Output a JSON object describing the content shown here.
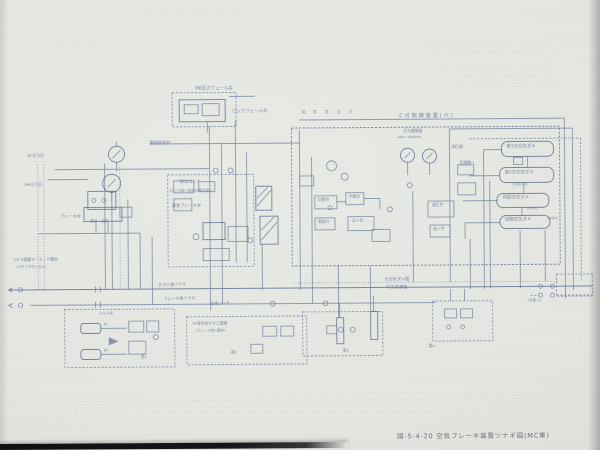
{
  "figure": {
    "caption": "図-5-4-20 空気ブレーキ装置ツナギ図(MC車)",
    "region_title": "C付制御装置(六)"
  },
  "schematic": {
    "ink_color": "#7281a0",
    "ink_dark": "#55648a",
    "paper_color": "#e4e6e1",
    "reservoirs": [
      "第1元空気ダメ",
      "第2元空気ダメ",
      "供給空気ダメ",
      "制御空気ダメ"
    ],
    "pipes": [
      "元空気ダメ管",
      "行先連通管",
      "ブレーキ管"
    ],
    "annotations": [
      {
        "t": "MR圧力フェール弁",
        "x": 196,
        "y": 87,
        "s": 4.4
      },
      {
        "t": "ロックフェール弁",
        "x": 233,
        "y": 110,
        "s": 4.4
      },
      {
        "t": "電磁給排弁",
        "x": 150,
        "y": 140,
        "s": 4.2
      },
      {
        "t": "締切コック",
        "x": 180,
        "y": 179,
        "s": 4.2
      },
      {
        "t": "ロック時ハ常用切替弁扱ヒ",
        "x": 170,
        "y": 189,
        "s": 3.6
      },
      {
        "t": "保安ブレーキ弁",
        "x": 172,
        "y": 203,
        "s": 4.2
      },
      {
        "t": "BC圧力計",
        "x": 28,
        "y": 152,
        "s": 3.8
      },
      {
        "t": "MR圧力計",
        "x": 25,
        "y": 181,
        "s": 3.8
      },
      {
        "t": "ブレーキ弁",
        "x": 60,
        "y": 213,
        "s": 4.2
      },
      {
        "t": "単弁・自弁",
        "x": 90,
        "y": 218,
        "s": 3.8
      },
      {
        "t": "給",
        "x": 303,
        "y": 111,
        "s": 3.2
      },
      {
        "t": "排",
        "x": 314,
        "y": 111,
        "s": 3.2
      },
      {
        "t": "制",
        "x": 326,
        "y": 111,
        "s": 3.2
      },
      {
        "t": "込",
        "x": 338,
        "y": 111,
        "s": 3.2
      },
      {
        "t": "圧",
        "x": 350,
        "y": 111,
        "s": 3.2
      },
      {
        "t": "圧力開閉器",
        "x": 404,
        "y": 130,
        "s": 3.8
      },
      {
        "t": "440〜490kPa",
        "x": 398,
        "y": 137,
        "s": 3.6
      },
      {
        "t": "調圧器",
        "x": 452,
        "y": 146,
        "s": 3.8
      },
      {
        "t": "切替弁",
        "x": 318,
        "y": 198,
        "s": 3.8
      },
      {
        "t": "中継弁",
        "x": 349,
        "y": 195,
        "s": 3.8
      },
      {
        "t": "電磁弁",
        "x": 318,
        "y": 220,
        "s": 3.8
      },
      {
        "t": "込メ弁",
        "x": 352,
        "y": 219,
        "s": 3.8
      },
      {
        "t": "調圧弁",
        "x": 432,
        "y": 204,
        "s": 3.8
      },
      {
        "t": "逃シ弁",
        "x": 433,
        "y": 228,
        "s": 3.8
      },
      {
        "t": "圧縮機ヘ",
        "x": 460,
        "y": 162,
        "s": 3.8
      },
      {
        "name": "reservoir-label",
        "t": "第1元空気ダメ",
        "x": 507,
        "y": 147,
        "s": 4.4
      },
      {
        "name": "reservoir-label",
        "t": "第2元空気ダメ",
        "x": 505,
        "y": 173,
        "s": 4.4
      },
      {
        "name": "reservoir-label",
        "t": "供給空気ダメ",
        "x": 503,
        "y": 198,
        "s": 4.4
      },
      {
        "name": "reservoir-label",
        "t": "制御空気ダメ",
        "x": 505,
        "y": 220,
        "s": 4.4
      },
      {
        "t": "(240ℓ×2)",
        "x": 513,
        "y": 185,
        "s": 3.2
      },
      {
        "t": "(150ℓ)",
        "x": 527,
        "y": 209,
        "s": 3.2
      },
      {
        "t": "(100ℓ)",
        "x": 548,
        "y": 219,
        "s": 3.2
      },
      {
        "name": "pipe-label",
        "t": "元空気ダメ管",
        "x": 384,
        "y": 278,
        "s": 4.2
      },
      {
        "name": "pipe-label",
        "t": "行先連通管",
        "x": 386,
        "y": 286,
        "s": 4.2
      },
      {
        "name": "pipe-label",
        "t": "元ダメ管ツナギ",
        "x": 158,
        "y": 282,
        "s": 4,
        "r": -2
      },
      {
        "name": "pipe-label",
        "t": "ブレーキ管ツナギ",
        "x": 163,
        "y": 296,
        "s": 4,
        "r": -2
      },
      {
        "t": "留置コック",
        "x": 210,
        "y": 301,
        "s": 3.8,
        "r": -2
      },
      {
        "t": "コチラ側妻ホースノミ関係",
        "x": 12,
        "y": 256,
        "s": 3.8
      },
      {
        "t": "(カギフタ付トスル)",
        "x": 16,
        "y": 264,
        "s": 3.4
      },
      {
        "t": "ユルメ弁",
        "x": 98,
        "y": 311,
        "s": 3.6
      },
      {
        "t": "BC",
        "x": 103,
        "y": 322,
        "s": 3.4
      },
      {
        "t": "BC",
        "x": 103,
        "y": 348,
        "s": 3.4
      },
      {
        "t": "M'車空気オサエ管理",
        "x": 192,
        "y": 321,
        "s": 3.8
      },
      {
        "t": "(ブレーキ時ニ動作)",
        "x": 195,
        "y": 329,
        "s": 3.4
      },
      {
        "t": "第1",
        "x": 140,
        "y": 354,
        "s": 3.8
      },
      {
        "t": "第2",
        "x": 230,
        "y": 350,
        "s": 3.8
      },
      {
        "t": "第3",
        "x": 342,
        "y": 349,
        "s": 3.8
      },
      {
        "t": "第4",
        "x": 428,
        "y": 345,
        "s": 3.8
      },
      {
        "t": "(次車ヘ)",
        "x": 527,
        "y": 301,
        "s": 3.6
      }
    ]
  }
}
